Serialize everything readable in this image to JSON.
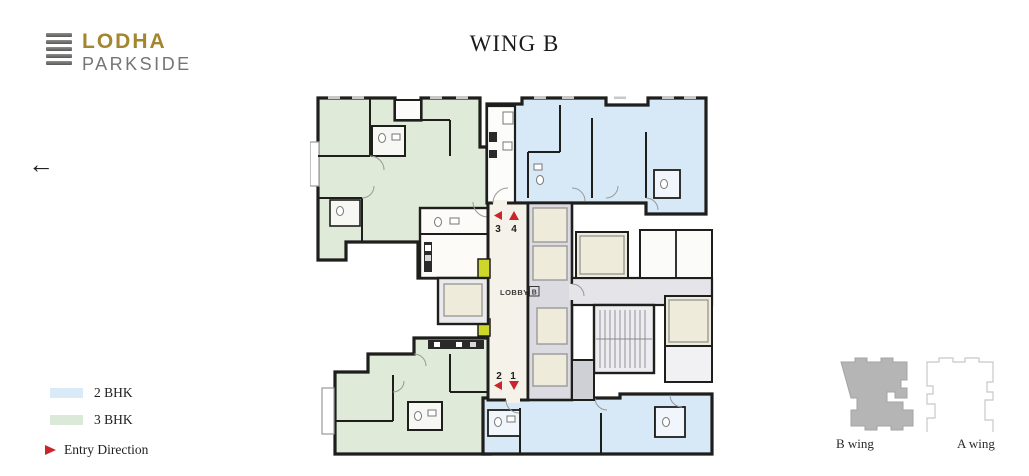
{
  "logo": {
    "brand": "LODHA",
    "name": "PARKSIDE"
  },
  "header": {
    "title": "WING B"
  },
  "nav": {
    "back_arrow": "←"
  },
  "floor_plan": {
    "lobby": {
      "label": "LOBBY",
      "wing_tag": "B"
    },
    "entry_markers": [
      {
        "num": "3",
        "direction": "left"
      },
      {
        "num": "4",
        "direction": "up"
      },
      {
        "num": "2",
        "direction": "left"
      },
      {
        "num": "1",
        "direction": "down"
      }
    ]
  },
  "legend": {
    "items": [
      {
        "label": "2 BHK",
        "color": "#d9eaf8"
      },
      {
        "label": "3 BHK",
        "color": "#dbe9d8"
      }
    ],
    "entry": {
      "label": "Entry Direction",
      "color": "#c9252b"
    }
  },
  "keyplan": {
    "wings": [
      {
        "label": "B wing",
        "active": true
      },
      {
        "label": "A wing",
        "active": false
      }
    ]
  },
  "colors": {
    "two_bhk": "#d7e8f6",
    "three_bhk": "#dfead9",
    "lobby": "#f5f2ea",
    "corridor": "#e4e4e9",
    "elevator_cab": "#eeebda",
    "service_duct": "#ccd62b",
    "wall": "#1e1e1c",
    "entry_red": "#c9252b",
    "keyplan_active": "#b5b5b5"
  }
}
